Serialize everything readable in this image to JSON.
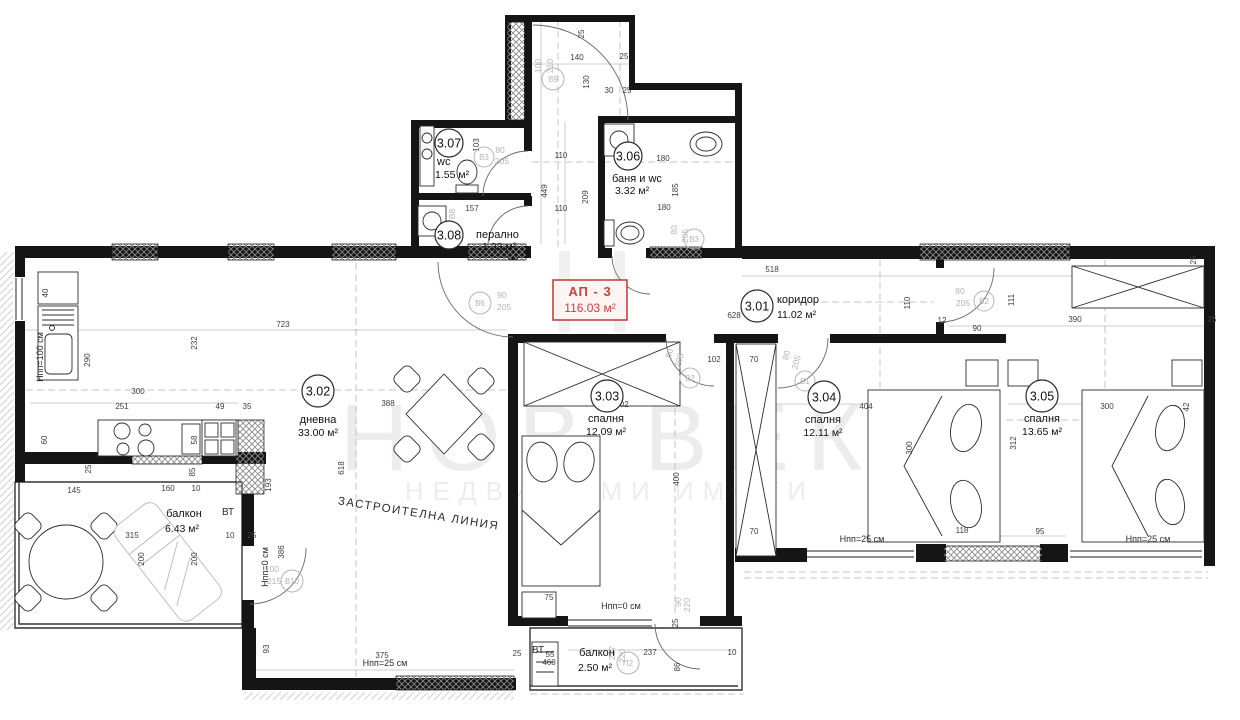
{
  "title": "Архитектурен план апартамент АП - 3",
  "watermark": {
    "letter": "Н",
    "line1": "НОВ ВЕК",
    "line2": "НЕДВИЖИМИ ИМОТИ"
  },
  "apartment": {
    "label": "АП - 3",
    "area": "116.03 м²"
  },
  "plan": {
    "rooms": [
      {
        "number": "3.01",
        "name": "коридор",
        "area": "11.02 м²",
        "cx": 757,
        "cy": 306,
        "cr": 16,
        "nx": 777,
        "ny": 303,
        "ax": 777,
        "ay": 318,
        "anchor": "start"
      },
      {
        "number": "3.02",
        "name": "дневна",
        "area": "33.00 м²",
        "cx": 318,
        "cy": 391,
        "cr": 16,
        "nx": 318,
        "ny": 423,
        "ax": 318,
        "ay": 436,
        "anchor": "middle"
      },
      {
        "number": "3.03",
        "name": "спалня",
        "area": "12.09 м²",
        "cx": 607,
        "cy": 396,
        "cr": 16,
        "nx": 606,
        "ny": 422,
        "ax": 606,
        "ay": 435,
        "anchor": "middle"
      },
      {
        "number": "3.04",
        "name": "спалня",
        "area": "12.11 м²",
        "cx": 824,
        "cy": 397,
        "cr": 16,
        "nx": 823,
        "ny": 423,
        "ax": 823,
        "ay": 436,
        "anchor": "middle"
      },
      {
        "number": "3.05",
        "name": "спалня",
        "area": "13.65 м²",
        "cx": 1042,
        "cy": 396,
        "cr": 16,
        "nx": 1042,
        "ny": 422,
        "ax": 1042,
        "ay": 435,
        "anchor": "middle"
      },
      {
        "number": "3.06",
        "name": "баня и wc",
        "area": "3.32 м²",
        "cx": 628,
        "cy": 156,
        "cr": 14,
        "nx": 612,
        "ny": 182,
        "ax": 615,
        "ay": 194,
        "anchor": "start"
      },
      {
        "number": "3.07",
        "name": "wc",
        "area": "1.55 м²",
        "cx": 449,
        "cy": 143,
        "cr": 14,
        "nx": 437,
        "ny": 165,
        "ax": 435,
        "ay": 178,
        "anchor": "start"
      },
      {
        "number": "3.08",
        "name": "перално",
        "area": "1.33 м²",
        "cx": 449,
        "cy": 235,
        "cr": 14,
        "nx": 476,
        "ny": 238,
        "ax": 482,
        "ay": 250,
        "anchor": "start"
      }
    ],
    "balconies": [
      {
        "name": "балкон",
        "area": "6.43 м²",
        "nx": 184,
        "ny": 517,
        "ax": 182,
        "ay": 532
      },
      {
        "name": "балкон",
        "area": "2.50 м²",
        "nx": 597,
        "ny": 656,
        "ax": 595,
        "ay": 671
      }
    ],
    "door_circles": [
      {
        "l": "В9",
        "x": 553,
        "y": 79,
        "r": 11
      },
      {
        "l": "В6",
        "x": 480,
        "y": 303,
        "r": 11
      },
      {
        "l": "В3",
        "x": 484,
        "y": 157,
        "r": 10
      },
      {
        "l": "В3",
        "x": 694,
        "y": 239,
        "r": 10
      },
      {
        "l": "В2",
        "x": 690,
        "y": 378,
        "r": 10
      },
      {
        "l": "В1",
        "x": 805,
        "y": 381,
        "r": 10
      },
      {
        "l": "В2",
        "x": 984,
        "y": 301,
        "r": 10
      },
      {
        "l": "В10",
        "x": 292,
        "y": 581,
        "r": 11
      },
      {
        "l": "П2",
        "x": 628,
        "y": 663,
        "r": 11
      }
    ],
    "door_size_labels": [
      {
        "t": "100",
        "x": 541,
        "y": 66,
        "r": -90
      },
      {
        "t": "210",
        "x": 553,
        "y": 66,
        "r": -90
      },
      {
        "t": "90",
        "x": 502,
        "y": 298
      },
      {
        "t": "205",
        "x": 504,
        "y": 310
      },
      {
        "t": "80",
        "x": 500,
        "y": 153
      },
      {
        "t": "205",
        "x": 502,
        "y": 164
      },
      {
        "t": "80",
        "x": 677,
        "y": 230,
        "r": -90
      },
      {
        "t": "205",
        "x": 688,
        "y": 236,
        "r": -90
      },
      {
        "t": "80",
        "x": 672,
        "y": 354,
        "r": -75
      },
      {
        "t": "205",
        "x": 682,
        "y": 361,
        "r": -75
      },
      {
        "t": "80",
        "x": 789,
        "y": 356,
        "r": -75
      },
      {
        "t": "205",
        "x": 799,
        "y": 363,
        "r": -75
      },
      {
        "t": "80",
        "x": 960,
        "y": 294
      },
      {
        "t": "205",
        "x": 963,
        "y": 306
      },
      {
        "t": "100",
        "x": 272,
        "y": 572
      },
      {
        "t": "215",
        "x": 274,
        "y": 584
      },
      {
        "t": "227",
        "x": 615,
        "y": 653,
        "r": -90
      },
      {
        "t": "220",
        "x": 625,
        "y": 656,
        "r": -90
      },
      {
        "t": "90",
        "x": 681,
        "y": 602,
        "r": -90
      },
      {
        "t": "220",
        "x": 690,
        "y": 605,
        "r": -90
      },
      {
        "t": "В8",
        "x": 455,
        "y": 214,
        "r": -90
      }
    ],
    "notes": [
      {
        "t": "ЗАСТРОИТЕЛНА ЛИНИЯ",
        "x": 418,
        "y": 517,
        "r": 9,
        "s": 11.5,
        "sp": 1.5
      },
      {
        "t": "ВТ",
        "x": 228,
        "y": 515,
        "s": 10
      },
      {
        "t": "ВТ",
        "x": 538,
        "y": 653,
        "s": 10
      },
      {
        "t": "Нпп=100 см",
        "x": 43,
        "y": 357,
        "r": -90,
        "s": 9
      },
      {
        "t": "Нпп=0 см",
        "x": 268,
        "y": 567,
        "r": -90,
        "s": 9
      },
      {
        "t": "Нпп=0 см",
        "x": 621,
        "y": 609,
        "s": 9
      },
      {
        "t": "Нпп=25 см",
        "x": 385,
        "y": 666,
        "s": 9
      },
      {
        "t": "Нпп=25 см",
        "x": 862,
        "y": 542,
        "s": 9
      },
      {
        "t": "Нпп=25 см",
        "x": 1148,
        "y": 542,
        "s": 9
      }
    ],
    "dimensions": [
      {
        "t": "140",
        "x": 577,
        "y": 60
      },
      {
        "t": "130",
        "x": 589,
        "y": 82,
        "r": -90
      },
      {
        "t": "25",
        "x": 584,
        "y": 34,
        "r": -90
      },
      {
        "t": "25",
        "x": 624,
        "y": 59
      },
      {
        "t": "30",
        "x": 609,
        "y": 93
      },
      {
        "t": "25",
        "x": 627,
        "y": 93
      },
      {
        "t": "449",
        "x": 547,
        "y": 191,
        "r": -90
      },
      {
        "t": "209",
        "x": 588,
        "y": 197,
        "r": -90
      },
      {
        "t": "110",
        "x": 561,
        "y": 158
      },
      {
        "t": "110",
        "x": 561,
        "y": 211
      },
      {
        "t": "103",
        "x": 479,
        "y": 145,
        "r": -90
      },
      {
        "t": "157",
        "x": 472,
        "y": 211
      },
      {
        "t": "180",
        "x": 663,
        "y": 161
      },
      {
        "t": "180",
        "x": 664,
        "y": 210
      },
      {
        "t": "185",
        "x": 678,
        "y": 190,
        "r": -90
      },
      {
        "t": "518",
        "x": 772,
        "y": 272
      },
      {
        "t": "628",
        "x": 734,
        "y": 318
      },
      {
        "t": "110",
        "x": 910,
        "y": 303,
        "r": -90
      },
      {
        "t": "12",
        "x": 942,
        "y": 323
      },
      {
        "t": "111",
        "x": 1014,
        "y": 300,
        "r": -90
      },
      {
        "t": "90",
        "x": 977,
        "y": 331
      },
      {
        "t": "390",
        "x": 1075,
        "y": 322
      },
      {
        "t": "25",
        "x": 1212,
        "y": 322
      },
      {
        "t": "25",
        "x": 1196,
        "y": 260,
        "r": -90
      },
      {
        "t": "723",
        "x": 283,
        "y": 327
      },
      {
        "t": "300",
        "x": 138,
        "y": 394
      },
      {
        "t": "251",
        "x": 122,
        "y": 409
      },
      {
        "t": "49",
        "x": 220,
        "y": 409
      },
      {
        "t": "35",
        "x": 247,
        "y": 409
      },
      {
        "t": "290",
        "x": 90,
        "y": 360,
        "r": -90
      },
      {
        "t": "232",
        "x": 197,
        "y": 343,
        "r": -90
      },
      {
        "t": "40",
        "x": 48,
        "y": 293,
        "r": -90
      },
      {
        "t": "60",
        "x": 47,
        "y": 440,
        "r": -90
      },
      {
        "t": "58",
        "x": 197,
        "y": 440,
        "r": -90
      },
      {
        "t": "85",
        "x": 195,
        "y": 472,
        "r": -90
      },
      {
        "t": "25",
        "x": 91,
        "y": 469,
        "r": -90
      },
      {
        "t": "388",
        "x": 388,
        "y": 406
      },
      {
        "t": "618",
        "x": 344,
        "y": 468,
        "r": -90
      },
      {
        "t": "193",
        "x": 271,
        "y": 485,
        "r": -90
      },
      {
        "t": "386",
        "x": 284,
        "y": 552,
        "r": -90
      },
      {
        "t": "145",
        "x": 74,
        "y": 493
      },
      {
        "t": "160",
        "x": 168,
        "y": 491
      },
      {
        "t": "10",
        "x": 196,
        "y": 491
      },
      {
        "t": "315",
        "x": 132,
        "y": 538
      },
      {
        "t": "200",
        "x": 144,
        "y": 559,
        "r": -90
      },
      {
        "t": "200",
        "x": 197,
        "y": 559,
        "r": -90
      },
      {
        "t": "10",
        "x": 230,
        "y": 538
      },
      {
        "t": "25",
        "x": 252,
        "y": 538
      },
      {
        "t": "93",
        "x": 269,
        "y": 649,
        "r": -90
      },
      {
        "t": "375",
        "x": 382,
        "y": 658
      },
      {
        "t": "75",
        "x": 549,
        "y": 600
      },
      {
        "t": "302",
        "x": 622,
        "y": 407
      },
      {
        "t": "400",
        "x": 679,
        "y": 479,
        "r": -90
      },
      {
        "t": "25",
        "x": 517,
        "y": 656
      },
      {
        "t": "55",
        "x": 550,
        "y": 657
      },
      {
        "t": "460",
        "x": 549,
        "y": 665
      },
      {
        "t": "237",
        "x": 650,
        "y": 655
      },
      {
        "t": "86",
        "x": 680,
        "y": 667,
        "r": -90
      },
      {
        "t": "10",
        "x": 732,
        "y": 655
      },
      {
        "t": "25",
        "x": 678,
        "y": 623,
        "r": -90
      },
      {
        "t": "118",
        "x": 962,
        "y": 533
      },
      {
        "t": "95",
        "x": 1040,
        "y": 534
      },
      {
        "t": "404",
        "x": 866,
        "y": 409
      },
      {
        "t": "300",
        "x": 912,
        "y": 448,
        "r": -90
      },
      {
        "t": "312",
        "x": 1016,
        "y": 443,
        "r": -90
      },
      {
        "t": "300",
        "x": 1107,
        "y": 409
      },
      {
        "t": "42",
        "x": 1189,
        "y": 407,
        "r": -90
      },
      {
        "t": "70",
        "x": 754,
        "y": 362
      },
      {
        "t": "70",
        "x": 754,
        "y": 534
      },
      {
        "t": "102",
        "x": 714,
        "y": 362
      }
    ]
  }
}
